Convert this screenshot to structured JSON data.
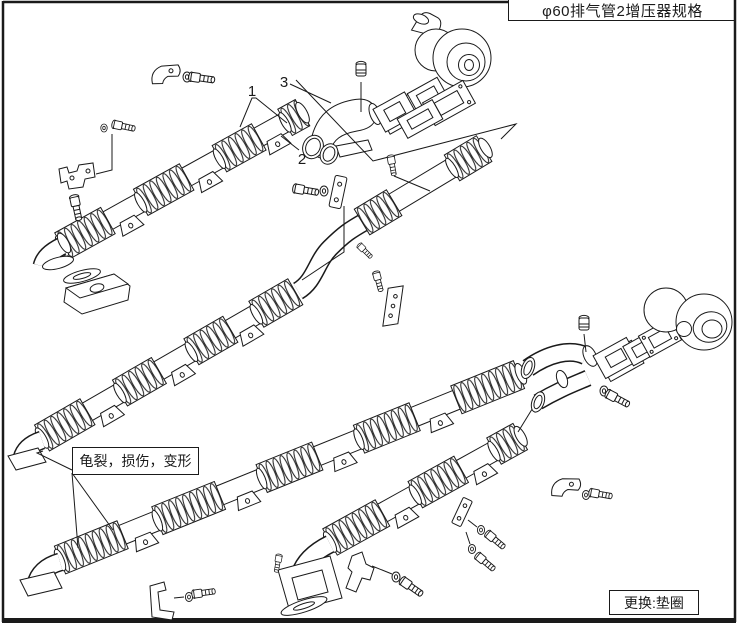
{
  "page": {
    "title": "φ60排气管2增压器规格",
    "replace_note": "更换:垫圈"
  },
  "annotations": {
    "callout_1": "1",
    "callout_2": "2",
    "callout_3": "3",
    "damage_label": "龟裂，损伤，变形"
  },
  "colors": {
    "line": "#1a1a1a",
    "background": "#ffffff"
  }
}
